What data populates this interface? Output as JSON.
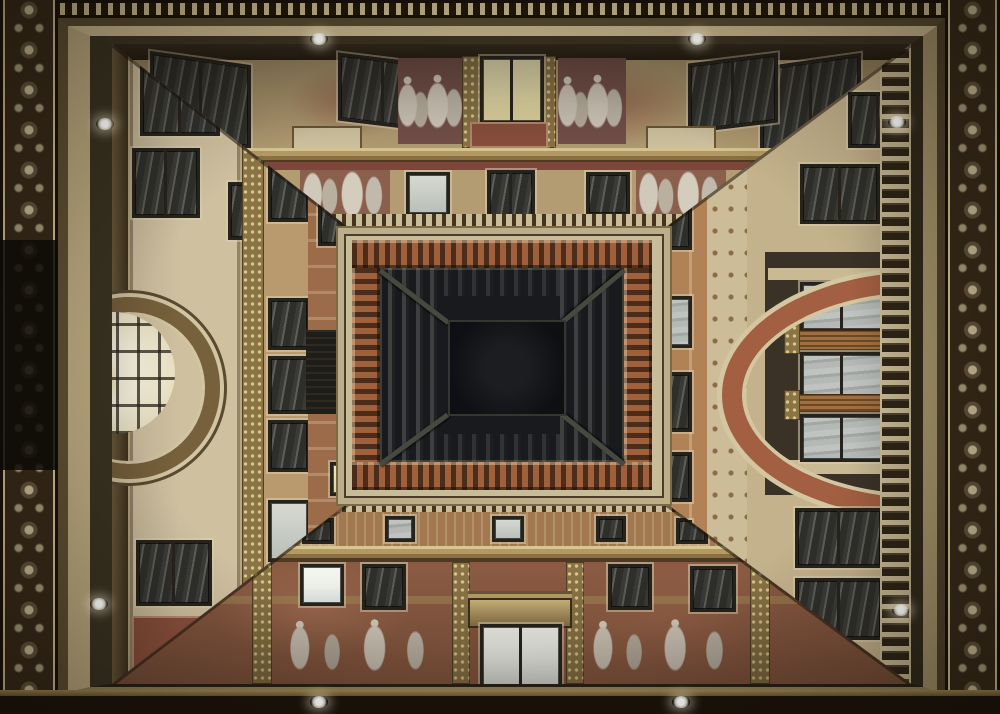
{
  "scene": {
    "description": "Low-angle photograph looking straight up inside an ornately frescoed gallery courtyard: four decorated facades with lit and dark windows converge on a dark rectangular glass skylight; a glowing arched window on the left, an orange arch with loggia on the right, gilded pilasters, painted figures, and dark scrollwork friezes framing the edges."
  },
  "palette": {
    "edge-dark": "#241b10",
    "frieze-brown": "#342817",
    "frieze-cream": "#c9ba92",
    "wall-cream": "#cfc0a0",
    "wall-tan": "#b5a077",
    "fresco-rust": "#96684a",
    "fresco-red": "#8a4f3c",
    "gold": "#8a7446",
    "cornice-orange": "#a0603c",
    "arch-olive": "#77613c",
    "arch-orange": "#a35f41",
    "arch-glow": "#f6f0da",
    "arch-glow-warm": "#eedd9a",
    "window-frame": "#26231d",
    "glass-dark": "#3a3b37",
    "glass-lit-white": "#f3f5ef",
    "glass-lit-warm": "#eee7ba",
    "skylight-dark": "#17181a",
    "skylight-rib": "#474840",
    "lamp-white": "#ffffff"
  }
}
